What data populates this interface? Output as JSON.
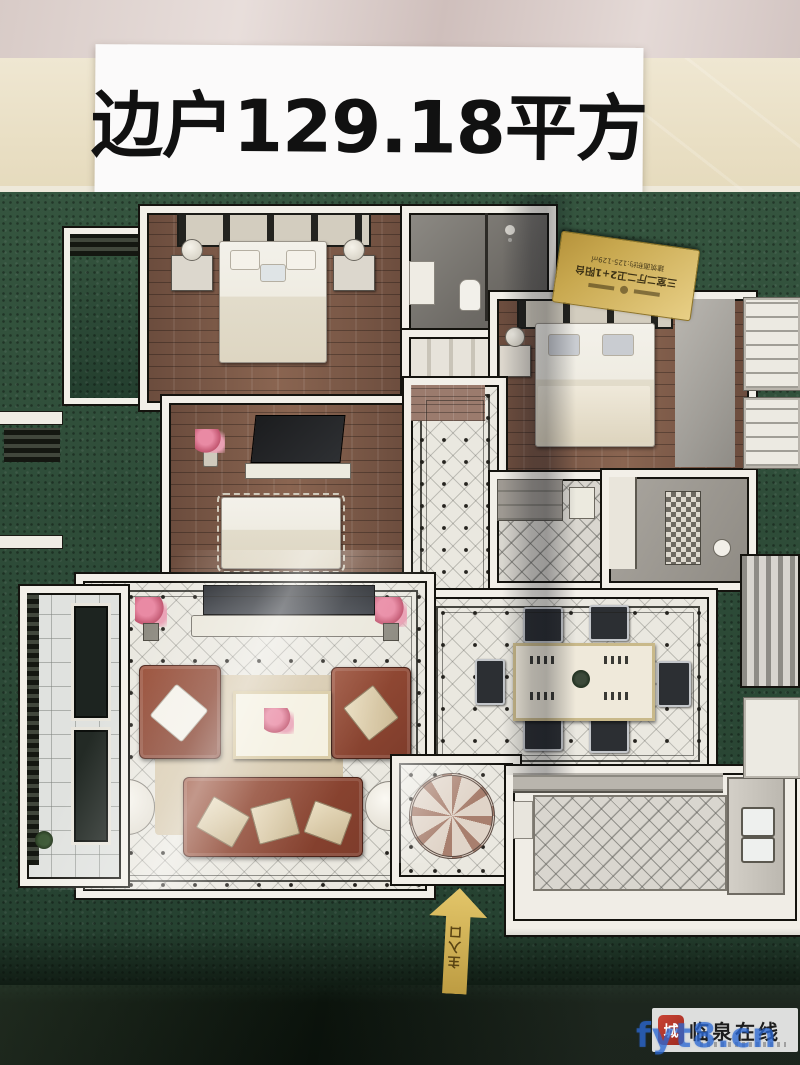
{
  "banner": {
    "text": "边户129.18平方"
  },
  "plaque": {
    "line_large": "三室二厅二卫2+1阳台",
    "line_mid": "建筑面积约:125-129㎡"
  },
  "entrance": {
    "label": "主入口"
  },
  "watermark": {
    "seal_text": "城",
    "site_name": "临泉在线",
    "overlay_url": "fyt8.cn"
  },
  "colors": {
    "turf_green": "#2c4937",
    "base_dark": "#0b130c",
    "wall_white": "#f2efe8",
    "wood_floor": "#7a5746",
    "tile_light": "#eae8e0",
    "sofa_brown": "#8e4734",
    "plaque_gold": "#d8bc6e",
    "arrow_gold": "#c9a94e",
    "banner_bg": "#fbfafa",
    "banner_text": "#111111",
    "watermark_blue": "#2b68d3",
    "seal_red": "#b33024"
  }
}
